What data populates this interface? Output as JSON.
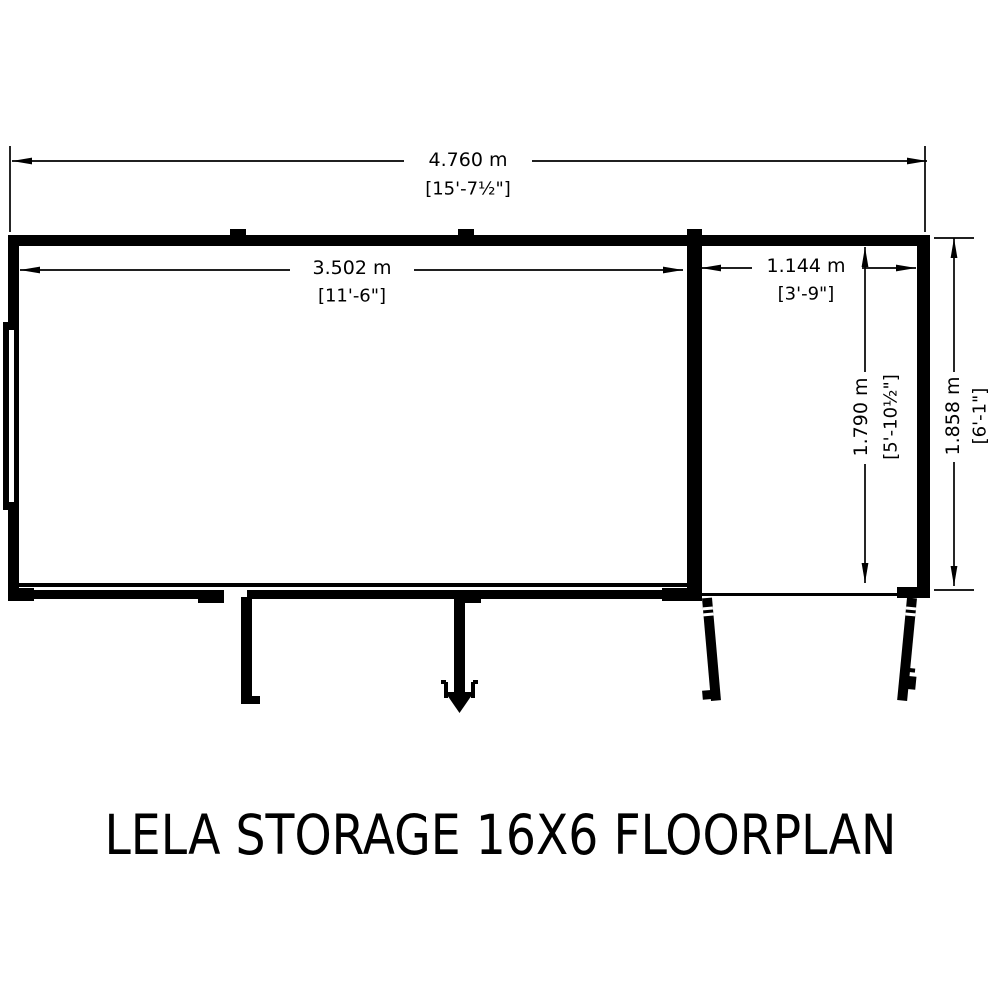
{
  "title": "LELA STORAGE 16X6 FLOORPLAN",
  "dimensions": {
    "overall_width": {
      "metric": "4.760 m",
      "imperial": "[15'-7½\"]"
    },
    "main_room_width": {
      "metric": "3.502 m",
      "imperial": "[11'-6\"]"
    },
    "side_room_width": {
      "metric": "1.144 m",
      "imperial": "[3'-9\"]"
    },
    "internal_depth": {
      "metric": "1.790 m",
      "imperial": "[5'-10½\"]"
    },
    "overall_depth": {
      "metric": "1.858 m",
      "imperial": "[6'-1\"]"
    }
  },
  "colors": {
    "line": "#000000",
    "background": "#ffffff"
  }
}
